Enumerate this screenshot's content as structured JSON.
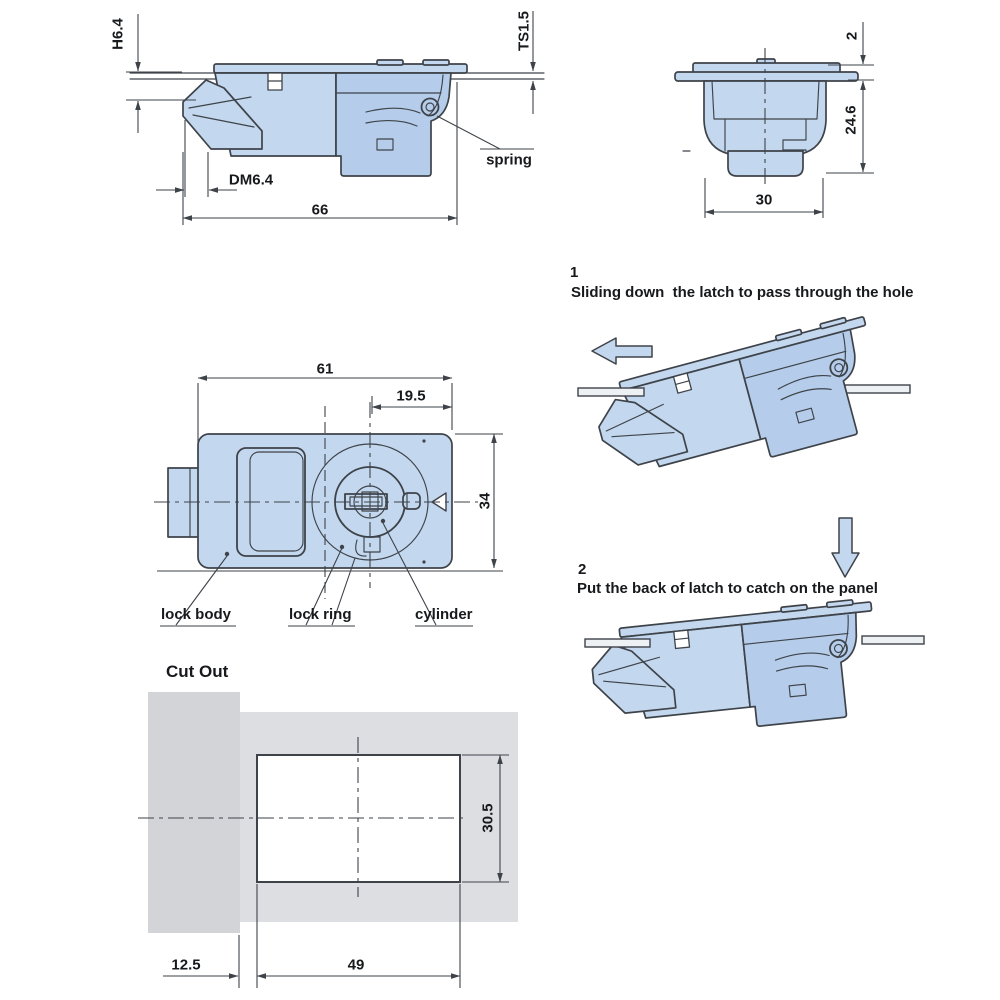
{
  "drawing": {
    "side_view": {
      "dim_h": "H6.4",
      "dim_ts": "TS1.5",
      "dim_dm": "DM6.4",
      "dim_width": "66",
      "label_spring": "spring"
    },
    "end_view": {
      "dim_flange": "2",
      "dim_depth": "24.6",
      "dim_width": "30"
    },
    "front_view": {
      "dim_width": "61",
      "dim_offset": "19.5",
      "dim_height": "34",
      "label_lock_body": "lock body",
      "label_lock_ring": "lock ring",
      "label_cylinder": "cylinder"
    },
    "steps": {
      "step1_number": "1",
      "step1_caption": "Sliding down  the latch to pass through the hole",
      "step2_number": "2",
      "step2_caption": "Put the back of latch to catch on the panel"
    },
    "cutout": {
      "title": "Cut Out",
      "dim_offset": "12.5",
      "dim_width": "49",
      "dim_height": "30.5"
    },
    "colors": {
      "part_fill": "#c3d7ee",
      "part_fill_dark": "#b5cdea",
      "outline": "#3e434a",
      "panel_gray_left": "#d2d4d7",
      "panel_gray_right": "#dcdee1",
      "rail_fill": "#eef1f4"
    }
  }
}
